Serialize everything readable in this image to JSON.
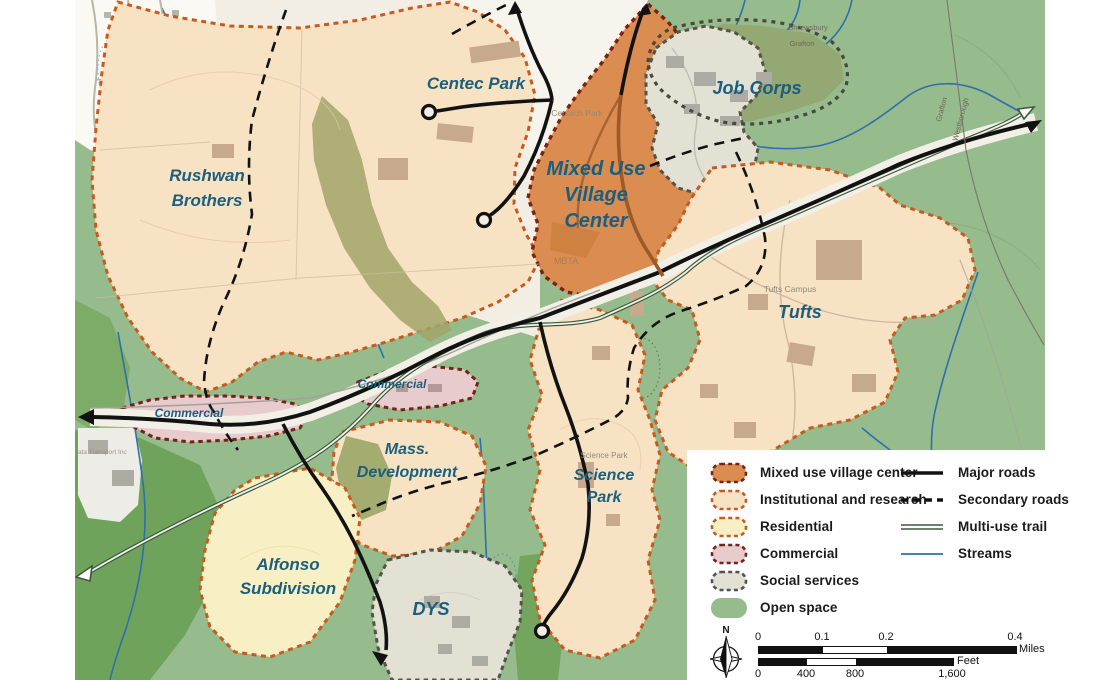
{
  "map": {
    "labels": {
      "rushwan_1": "Rushwan",
      "rushwan_2": "Brothers",
      "centec": "Centec Park",
      "mixed_1": "Mixed Use",
      "mixed_2": "Village",
      "mixed_3": "Center",
      "job_corps": "Job Corps",
      "tufts": "Tufts",
      "science_1": "Science",
      "science_2": "Park",
      "mass_1": "Mass.",
      "mass_2": "Development",
      "alfonso_1": "Alfonso",
      "alfonso_2": "Subdivision",
      "dys": "DYS",
      "commercial_west": "Commercial",
      "commercial_mid": "Commercial"
    },
    "base_labels": {
      "centech_park": "Centech Park",
      "mbta": "MBTA",
      "tufts_campus": "Tufts Campus",
      "science_park": "Science Park",
      "shrewsbury": "Shrewsbury",
      "grafton": "Grafton",
      "grafton_rot": "Grafton",
      "westborough": "Westborough",
      "data_transport": "Data Transport Inc"
    }
  },
  "colors": {
    "mixed_use": "#DB8C50",
    "mixed_use_border": "#7E2012",
    "institutional": "#F7E2C4",
    "institutional_border": "#C75B1E",
    "residential": "#F8F0C4",
    "residential_border": "#C75B1E",
    "commercial": "#E8CBCD",
    "commercial_border": "#75221A",
    "social": "#E2E1D4",
    "social_border": "#55524A",
    "open_space": "#96BB8D",
    "open_space_dark": "#6FA35C",
    "olive": "#A2A469",
    "stream": "#2E6FAD",
    "road": "#121212",
    "trail": "#3A5A3C",
    "brown_road": "#9C5A28",
    "label": "#1B5E7D"
  },
  "legend": {
    "zones": [
      {
        "label": "Mixed use village center"
      },
      {
        "label": "Institutional and research"
      },
      {
        "label": "Residential"
      },
      {
        "label": "Commercial"
      },
      {
        "label": "Social services"
      },
      {
        "label": "Open space"
      }
    ],
    "lines": [
      {
        "label": "Major roads"
      },
      {
        "label": "Secondary roads"
      },
      {
        "label": "Multi-use trail"
      },
      {
        "label": "Streams"
      }
    ]
  },
  "scale": {
    "north": "N",
    "miles_ticks": [
      "0",
      "0.1",
      "0.2",
      "0.4"
    ],
    "miles_unit": "Miles",
    "feet_ticks": [
      "0",
      "400",
      "800",
      "1,600"
    ],
    "feet_unit": "Feet"
  }
}
